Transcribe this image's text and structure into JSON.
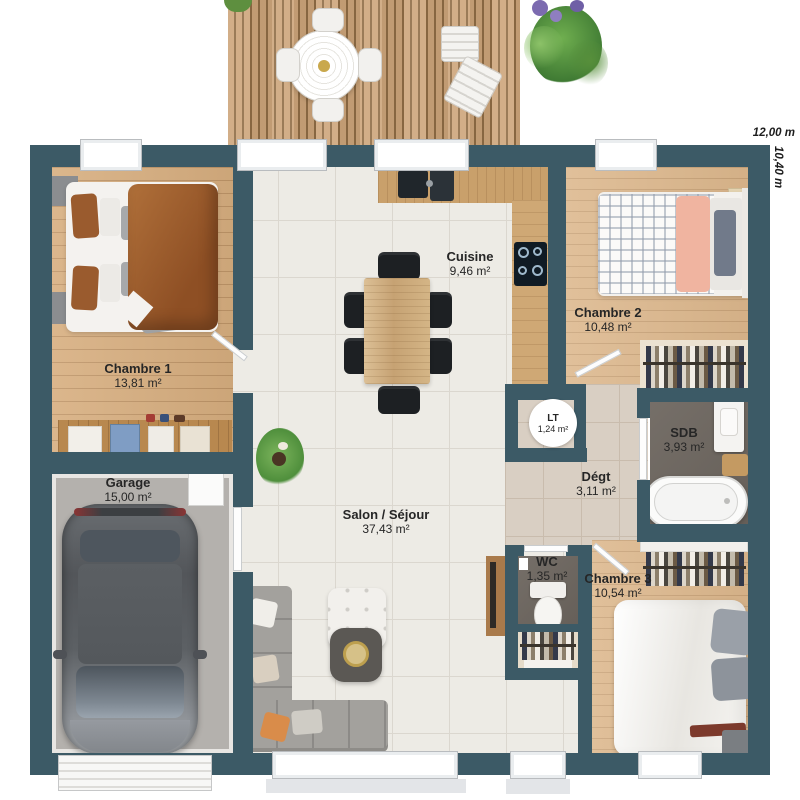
{
  "plan": {
    "dim_width": "12,00 m",
    "dim_height": "10,40 m",
    "rooms": [
      {
        "name": "Chambre 1",
        "area": "13,81 m²"
      },
      {
        "name": "Garage",
        "area": "15,00 m²"
      },
      {
        "name": "Cuisine",
        "area": "9,46 m²"
      },
      {
        "name": "Chambre 2",
        "area": "10,48 m²"
      },
      {
        "name": "LT",
        "area": "1,24 m²"
      },
      {
        "name": "Dégt",
        "area": "3,11 m²"
      },
      {
        "name": "SDB",
        "area": "3,93 m²"
      },
      {
        "name": "WC",
        "area": "1,35 m²"
      },
      {
        "name": "Chambre 3",
        "area": "10,54 m²"
      },
      {
        "name": "Salon / Séjour",
        "area": "37,43 m²"
      }
    ],
    "colors": {
      "wall": "#3c5a66",
      "deck_wood": "#cda57a",
      "floor_wood": "#d7ae7f",
      "tile": "#edebe5",
      "hall_tile": "#d9cfc3",
      "wet_floor": "#6e6760",
      "accent_gold": "#bd9f4e",
      "duvet_brown": "#a15f2c",
      "blanket_pink": "#f0b4a0"
    }
  }
}
